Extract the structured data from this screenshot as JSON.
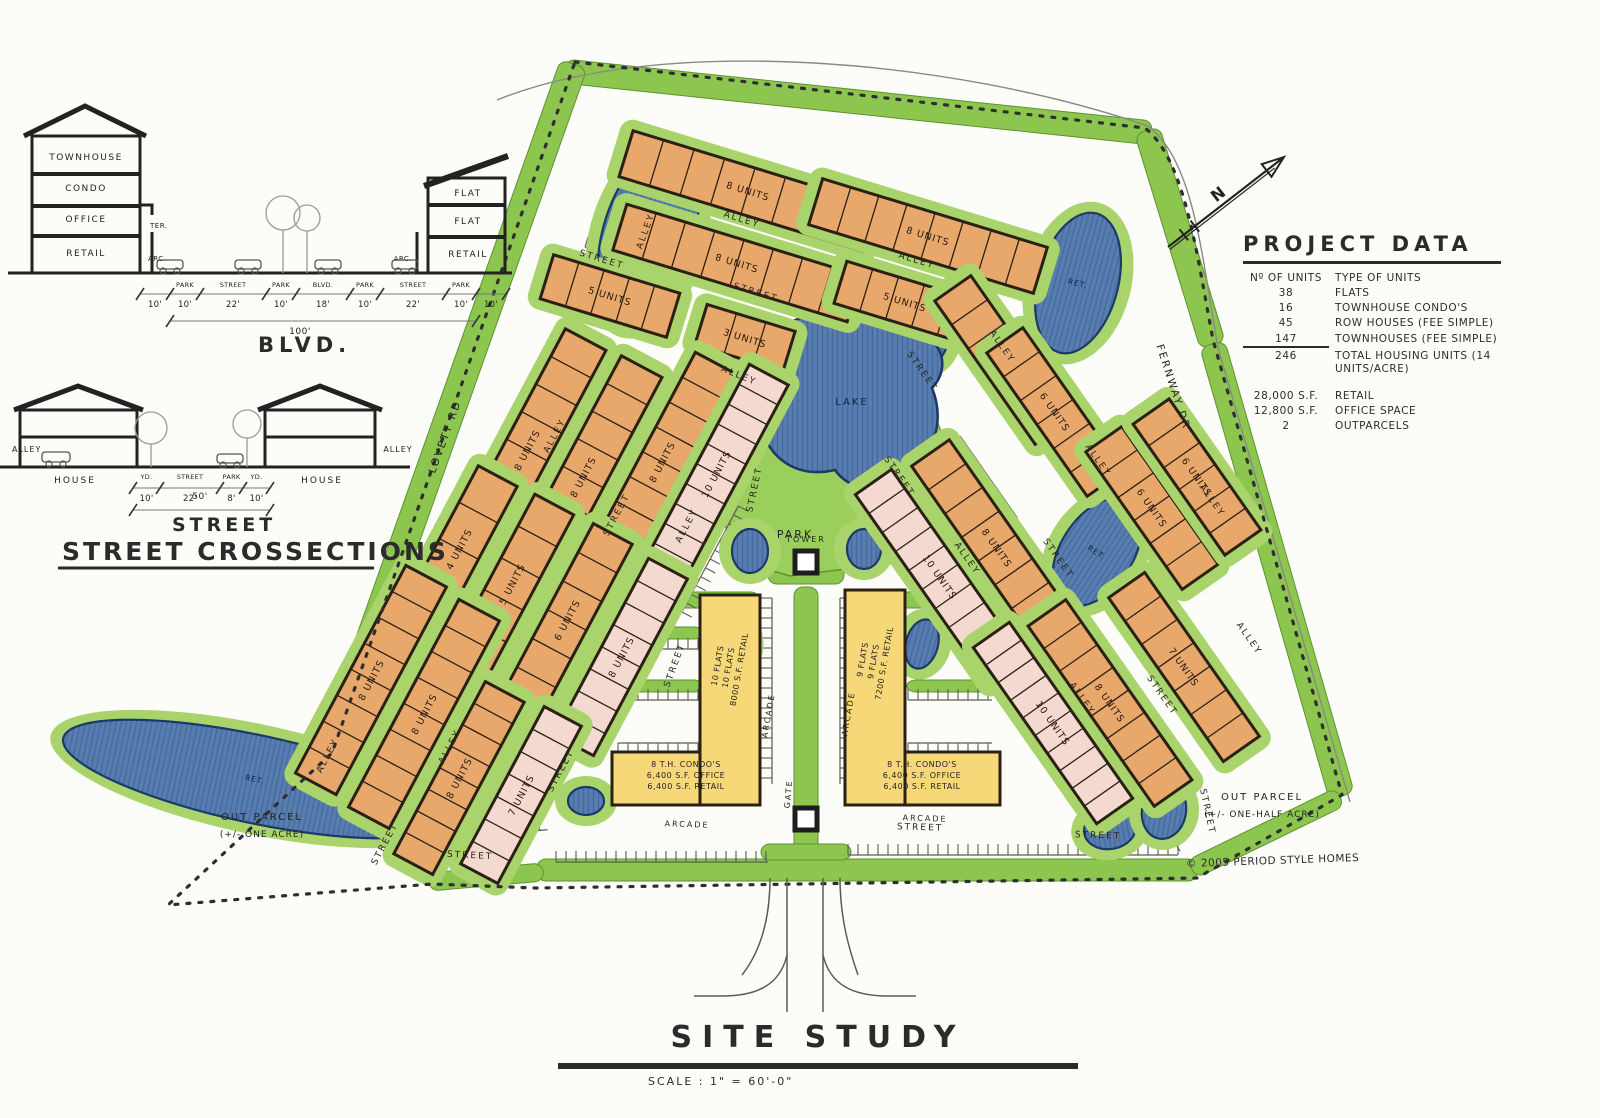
{
  "page": {
    "title": "SITE STUDY",
    "scale": "SCALE : 1\" = 60'-0\"",
    "copyright": "© 2005 PERIOD STYLE HOMES",
    "north_label": "N"
  },
  "sections": {
    "heading": "STREET CROSSECTIONS",
    "blvd": {
      "title": "BLVD.",
      "left_building": {
        "floors": [
          "TOWNHOUSE",
          "CONDO",
          "OFFICE",
          "RETAIL"
        ],
        "annotations": [
          "TER.",
          "ARC."
        ]
      },
      "right_building": {
        "floors": [
          "FLAT",
          "FLAT",
          "RETAIL"
        ],
        "annotations": [
          "ARC."
        ]
      },
      "dims": [
        {
          "name": "",
          "width": "10'"
        },
        {
          "name": "PARK",
          "width": "10'"
        },
        {
          "name": "STREET",
          "width": "22'"
        },
        {
          "name": "PARK",
          "width": "10'"
        },
        {
          "name": "BLVD.",
          "width": "18'"
        },
        {
          "name": "PARK",
          "width": "10'"
        },
        {
          "name": "STREET",
          "width": "22'"
        },
        {
          "name": "PARK",
          "width": "10'"
        },
        {
          "name": "",
          "width": "10'"
        }
      ],
      "total": "100'"
    },
    "street": {
      "title": "STREET",
      "left_label": "ALLEY",
      "right_label": "ALLEY",
      "left_house": "HOUSE",
      "right_house": "HOUSE",
      "dims": [
        {
          "name": "YD.",
          "width": "10'"
        },
        {
          "name": "STREET",
          "width": "22'"
        },
        {
          "name": "PARK",
          "width": "8'"
        },
        {
          "name": "YD.",
          "width": "10'"
        }
      ],
      "total": "50'"
    }
  },
  "project_data": {
    "title": "PROJECT DATA",
    "header": {
      "left": "Nº OF UNITS",
      "right": "TYPE OF UNITS"
    },
    "unit_rows": [
      [
        "38",
        "FLATS"
      ],
      [
        "16",
        "TOWNHOUSE CONDO'S"
      ],
      [
        "45",
        "ROW HOUSES (FEE SIMPLE)"
      ],
      [
        "147",
        "TOWNHOUSES (FEE SIMPLE)"
      ],
      [
        "246",
        "TOTAL HOUSING UNITS (14 UNITS/ACRE)"
      ]
    ],
    "area_rows": [
      [
        "28,000 S.F.",
        "RETAIL"
      ],
      [
        "12,800 S.F.",
        "OFFICE SPACE"
      ],
      [
        "2",
        "OUTPARCELS"
      ]
    ]
  },
  "colors": {
    "paper": "#fcfcf9",
    "green_band": "#8dc64f",
    "green_pad": "#a9d46c",
    "park": "#9bcf5b",
    "green_stroke": "#5d9230",
    "pond": "#587daf",
    "pond_hatch": "#46689c",
    "pond_stroke": "#1c3a69",
    "orange": "#e9a86b",
    "pink": "#f4d9d1",
    "yellow": "#f7d879",
    "ink": "#2b2b2b",
    "outline": "#2b2014"
  },
  "site": {
    "boundary_path": "M575,62 L1145,128 C1185,160 1196,250 1213,340 L1342,795 L1197,878 L535,888 L432,884 L168,905 L332,753 Z",
    "outer_lines": [
      "M497,100 C660,34 950,58 1148,126",
      "M1148,126 C1194,160 1202,258 1218,348 L1350,802"
    ],
    "park_points": "700,472 742,332 902,326 955,470 902,562 790,576 742,562",
    "park_label": "PARK",
    "lake_path": "M780,330 C750,355 748,395 762,430 C772,462 800,478 835,470 C850,492 885,495 905,478 C935,455 945,420 932,388 C948,372 945,345 925,338 C905,318 868,312 845,322 C825,310 795,315 780,330 Z",
    "lake_label": "LAKE",
    "green_strips": [
      [
        858,
        102,
        590,
        24,
        6
      ],
      [
        452,
        408,
        730,
        28,
        -70.5
      ],
      [
        1180,
        238,
        225,
        26,
        73
      ],
      [
        1277,
        570,
        470,
        26,
        74
      ],
      [
        867,
        870,
        660,
        22,
        0
      ],
      [
        1266,
        833,
        165,
        20,
        -26
      ],
      [
        486,
        877,
        115,
        18,
        -5
      ],
      [
        427,
        795,
        212,
        18,
        24
      ],
      [
        806,
        722,
        270,
        24,
        90
      ],
      [
        702,
        600,
        115,
        16,
        0
      ],
      [
        657,
        633,
        92,
        12,
        0
      ],
      [
        657,
        686,
        92,
        12,
        0
      ],
      [
        908,
        600,
        115,
        16,
        0
      ],
      [
        953,
        633,
        92,
        12,
        0
      ],
      [
        953,
        686,
        92,
        12,
        0
      ],
      [
        806,
        561,
        76,
        46,
        0
      ],
      [
        806,
        852,
        90,
        16,
        0
      ]
    ],
    "buildings": [
      [
        "8 UNITS",
        748,
        191,
        255,
        48,
        17,
        "o"
      ],
      [
        "8 UNITS",
        928,
        236,
        235,
        48,
        17,
        "o"
      ],
      [
        "8 UNITS",
        737,
        263,
        245,
        48,
        17,
        "o"
      ],
      [
        "5 UNITS",
        905,
        302,
        135,
        44,
        17,
        "o"
      ],
      [
        "5 UNITS",
        610,
        296,
        132,
        46,
        17,
        "o"
      ],
      [
        "3 UNITS",
        745,
        338,
        92,
        42,
        17,
        "o"
      ],
      [
        "8 UNITS",
        527,
        450,
        250,
        46,
        -62,
        "o"
      ],
      [
        "8 UNITS",
        583,
        477,
        250,
        46,
        -62,
        "o"
      ],
      [
        "8 UNITS",
        662,
        462,
        225,
        44,
        -62,
        "o"
      ],
      [
        "10 UNITS",
        716,
        474,
        225,
        44,
        -62,
        "p"
      ],
      [
        "4 UNITS",
        459,
        549,
        165,
        44,
        -62,
        "o"
      ],
      [
        "5 UNITS",
        512,
        584,
        180,
        44,
        -62,
        "o"
      ],
      [
        "6 UNITS",
        567,
        620,
        195,
        44,
        -62,
        "o"
      ],
      [
        "8 UNITS",
        621,
        657,
        200,
        44,
        -62,
        "p"
      ],
      [
        "8 UNITS",
        371,
        680,
        235,
        46,
        -62,
        "o"
      ],
      [
        "8 UNITS",
        424,
        714,
        235,
        46,
        -62,
        "o"
      ],
      [
        "8 UNITS",
        459,
        778,
        195,
        44,
        -62,
        "o"
      ],
      [
        "7 UNITS",
        521,
        795,
        178,
        42,
        -62,
        "p"
      ],
      [
        "6 UNITS",
        1003,
        360,
        175,
        44,
        55,
        "o"
      ],
      [
        "6 UNITS",
        1055,
        412,
        175,
        44,
        55,
        "o"
      ],
      [
        "6 UNITS",
        1152,
        508,
        168,
        44,
        55,
        "o"
      ],
      [
        "6 UNITS",
        1197,
        477,
        160,
        44,
        55,
        "o"
      ],
      [
        "10 UNITS",
        940,
        577,
        232,
        44,
        55,
        "p"
      ],
      [
        "8 UNITS",
        997,
        548,
        232,
        46,
        55,
        "o"
      ],
      [
        "10 UNITS",
        1053,
        723,
        215,
        44,
        55,
        "p"
      ],
      [
        "8 UNITS",
        1110,
        703,
        220,
        46,
        55,
        "o"
      ],
      [
        "7 UNITS",
        1184,
        667,
        200,
        44,
        55,
        "o"
      ]
    ],
    "ponds": [
      [
        648,
        238,
        46,
        92,
        15,
        "RET."
      ],
      [
        1078,
        283,
        40,
        72,
        15,
        "RET."
      ],
      [
        932,
        340,
        16,
        26,
        15,
        ""
      ],
      [
        1097,
        552,
        36,
        60,
        33,
        "RET."
      ],
      [
        750,
        551,
        18,
        22,
        0,
        ""
      ],
      [
        864,
        549,
        17,
        20,
        0,
        ""
      ],
      [
        733,
        640,
        17,
        26,
        -15,
        ""
      ],
      [
        922,
        644,
        16,
        25,
        15,
        ""
      ],
      [
        255,
        779,
        196,
        44,
        12,
        "RET."
      ],
      [
        464,
        820,
        40,
        20,
        8,
        ""
      ],
      [
        586,
        801,
        18,
        14,
        0,
        ""
      ],
      [
        448,
        838,
        24,
        16,
        0,
        ""
      ],
      [
        1110,
        829,
        26,
        20,
        -10,
        ""
      ],
      [
        1164,
        811,
        22,
        28,
        10,
        ""
      ],
      [
        492,
        631,
        17,
        14,
        -60,
        ""
      ],
      [
        432,
        585,
        14,
        18,
        -60,
        ""
      ]
    ],
    "labels": [
      [
        "ALLEY",
        741,
        222,
        17
      ],
      [
        "ALLEY",
        916,
        263,
        17
      ],
      [
        "STREET",
        601,
        262,
        17
      ],
      [
        "STREET",
        755,
        295,
        17
      ],
      [
        "ALLEY",
        648,
        232,
        -70
      ],
      [
        "ALLEY",
        738,
        378,
        22
      ],
      [
        "STREET",
        757,
        490,
        -78
      ],
      [
        "PARK",
        795,
        538,
        0,
        11
      ],
      [
        "STREET",
        920,
        373,
        55
      ],
      [
        "ALLEY",
        1000,
        348,
        55
      ],
      [
        "STREET",
        1056,
        560,
        55
      ],
      [
        "ALLEY",
        1096,
        462,
        55
      ],
      [
        "ALLEY",
        1210,
        502,
        55
      ],
      [
        "LOVETT RD",
        448,
        438,
        -70,
        10.5
      ],
      [
        "FERNWAY DR",
        1170,
        388,
        72,
        10.5
      ],
      [
        "ALLEY",
        557,
        437,
        -62
      ],
      [
        "STREET",
        619,
        516,
        -62
      ],
      [
        "ALLEY",
        689,
        527,
        -62
      ],
      [
        "ALLEY",
        330,
        757,
        -62
      ],
      [
        "STREET",
        387,
        845,
        -62
      ],
      [
        "ALLEY",
        452,
        748,
        -62
      ],
      [
        "STREET",
        563,
        772,
        -62
      ],
      [
        "STREET",
        677,
        666,
        -70
      ],
      [
        "STREET",
        470,
        858,
        3
      ],
      [
        "STREET",
        920,
        830,
        2
      ],
      [
        "STREET",
        1098,
        838,
        2
      ],
      [
        "ARCADE",
        687,
        827,
        2,
        8
      ],
      [
        "ARCADE",
        925,
        821,
        2,
        8
      ],
      [
        "ARCADE",
        771,
        716,
        -80,
        8
      ],
      [
        "ARCADE",
        851,
        714,
        -80,
        8
      ],
      [
        "STREET",
        1205,
        812,
        78
      ],
      [
        "ALLEY",
        1080,
        700,
        55
      ],
      [
        "STREET",
        1160,
        697,
        55
      ],
      [
        "ALLEY",
        1247,
        640,
        55
      ],
      [
        "STREET",
        897,
        478,
        55
      ],
      [
        "ALLEY",
        965,
        560,
        55
      ],
      [
        "TOWER",
        806,
        542,
        0,
        8
      ],
      [
        "GATE",
        791,
        794,
        -85,
        8
      ]
    ],
    "mixed_use": [
      {
        "bar": [
          700,
          595,
          60,
          210
        ],
        "base": [
          612,
          752,
          148,
          53
        ],
        "bar_text": [
          "10 FLATS",
          "10 FLATS",
          "8000 S.F. RETAIL"
        ],
        "bar_xy": [
          731,
          668
        ],
        "base_text": [
          "8 T.H. CONDO'S",
          "6,400 S.F. OFFICE",
          "6,400 S.F. RETAIL"
        ],
        "base_xy": [
          686,
          767
        ]
      },
      {
        "bar": [
          845,
          590,
          60,
          215
        ],
        "base": [
          845,
          752,
          155,
          53
        ],
        "bar_text": [
          "9 FLATS",
          "9 FLATS",
          "7200 S.F. RETAIL"
        ],
        "bar_xy": [
          876,
          662
        ],
        "base_text": [
          "8 T.H. CONDO'S",
          "6,400 S.F. OFFICE",
          "6,400 S.F. RETAIL"
        ],
        "base_xy": [
          922,
          767
        ]
      }
    ],
    "tower_rect": [
      795,
      551,
      22,
      22
    ],
    "gate_rect": [
      795,
      808,
      22,
      22
    ],
    "out_parcels": [
      {
        "line1": "OUT PARCEL",
        "line2": "(+/- ONE ACRE)",
        "x": 262,
        "y": 820
      },
      {
        "line1": "OUT PARCEL",
        "line2": "(+/- ONE-HALF ACRE)",
        "x": 1262,
        "y": 800
      }
    ],
    "combs": [
      [
        618,
        649,
        84,
        0,
        1
      ],
      [
        618,
        700,
        84,
        0,
        1
      ],
      [
        618,
        743,
        84,
        0,
        -1
      ],
      [
        908,
        649,
        84,
        0,
        1
      ],
      [
        908,
        700,
        84,
        0,
        1
      ],
      [
        908,
        743,
        84,
        0,
        -1
      ],
      [
        772,
        598,
        186,
        90,
        -1
      ],
      [
        840,
        598,
        186,
        90,
        1
      ],
      [
        556,
        862,
        212,
        0,
        1
      ],
      [
        848,
        855,
        330,
        0,
        1
      ],
      [
        430,
        840,
        118,
        -5,
        1
      ],
      [
        588,
        567,
        132,
        -62,
        1
      ],
      [
        682,
        612,
        120,
        -62,
        -1
      ],
      [
        874,
        502,
        118,
        55,
        -1
      ],
      [
        1108,
        748,
        126,
        55,
        1
      ],
      [
        585,
        247,
        92,
        17,
        1
      ],
      [
        788,
        302,
        82,
        17,
        1
      ],
      [
        960,
        436,
        100,
        55,
        -1
      ]
    ],
    "entry_paths": [
      "M787,878 L787,1012",
      "M823,878 L823,1012",
      "M787,955 C780,985 757,996 722,996 L694,996",
      "M823,955 C830,985 853,996 888,996 L916,996",
      "M770,878 C770,920 760,952 742,975",
      "M840,878 C840,920 850,952 858,975"
    ],
    "north": {
      "x1": 1168,
      "y1": 247,
      "x2": 1284,
      "y2": 157,
      "lx": 1222,
      "ly": 198
    }
  }
}
